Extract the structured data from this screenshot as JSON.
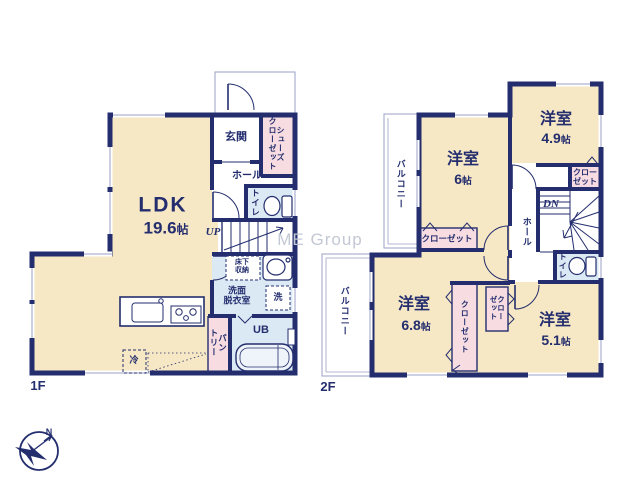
{
  "watermark": "ME Group",
  "compass": {
    "north": "N"
  },
  "colors": {
    "wall": "#242e6e",
    "room_fill": "#f6e7c5",
    "wet_fill": "#dbe9f4",
    "closet_fill": "#f7dde2",
    "thin_line": "#9aa2c4",
    "watermark": "#c3c8d4"
  },
  "floor1": {
    "label": "1F",
    "ldk": {
      "name": "LDK",
      "size": "19.6",
      "unit": "帖"
    },
    "genkan": "玄関",
    "shoes_closet": {
      "line1": "シューズ",
      "line2": "クローゼット"
    },
    "hall": "ホール",
    "toilet": "トイレ",
    "stairs": "UP",
    "underfloor": {
      "line1": "床下",
      "line2": "収納"
    },
    "washroom": {
      "line1": "洗面",
      "line2": "脱衣室"
    },
    "washer": "洗",
    "bath": "UB",
    "pantry": {
      "line1": "パン",
      "line2": "トリー"
    },
    "fridge": "冷"
  },
  "floor2": {
    "label": "2F",
    "room6": {
      "name": "洋室",
      "size": "6",
      "unit": "帖"
    },
    "room49": {
      "name": "洋室",
      "size": "4.9",
      "unit": "帖"
    },
    "room68": {
      "name": "洋室",
      "size": "6.8",
      "unit": "帖"
    },
    "room51": {
      "name": "洋室",
      "size": "5.1",
      "unit": "帖"
    },
    "balcony_upper": "バルコニー",
    "balcony_lower": "バルコニー",
    "closet_room6": "クローゼット",
    "closet_room49": {
      "line1": "クロー",
      "line2": "ゼット"
    },
    "closet_room68": "クローゼット",
    "closet_room51": {
      "line1": "クロー",
      "line2": "ゼット"
    },
    "hall": "ホール",
    "stairs": "DN",
    "toilet": "トイレ"
  }
}
